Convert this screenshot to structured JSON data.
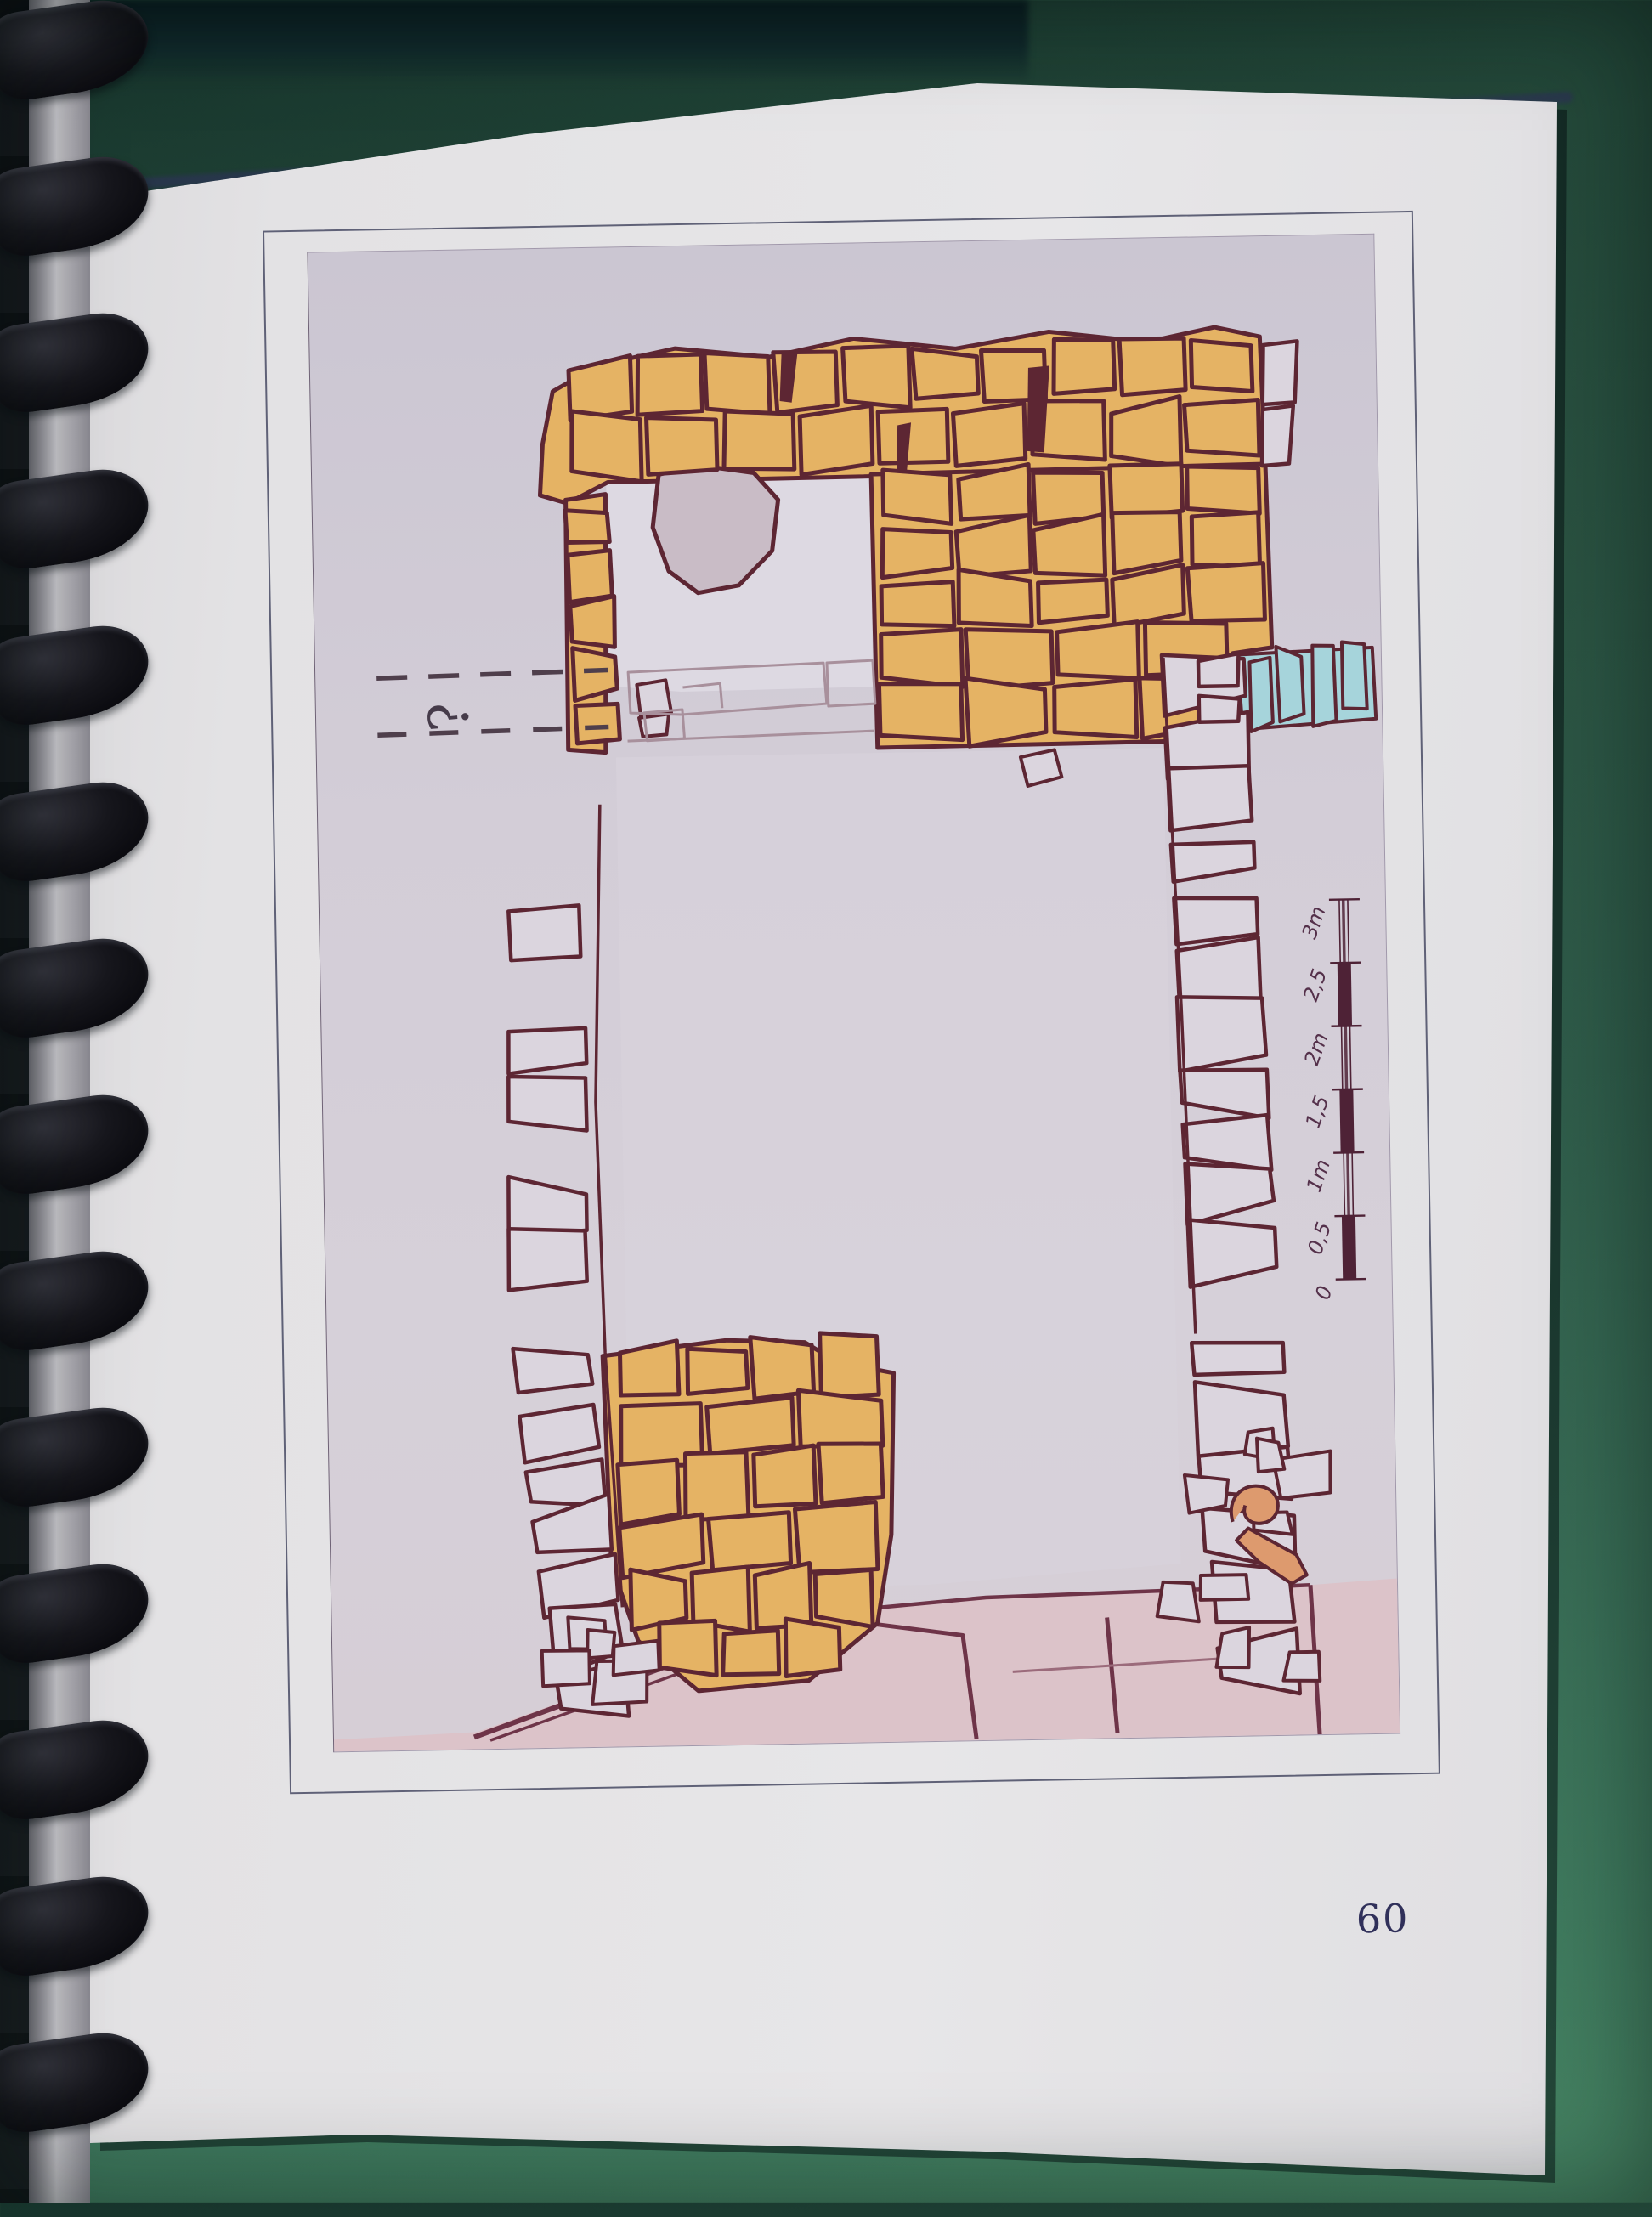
{
  "page": {
    "number": "60"
  },
  "figure": {
    "question_mark": "?",
    "scalebar": {
      "labels": [
        "0",
        "0,5",
        "1m",
        "1,5",
        "2m",
        "2,5",
        "3m"
      ]
    }
  },
  "colors": {
    "desk_green": "#2e5a47",
    "page": "#e4e3e5",
    "plate": "#d3cdd7",
    "ochre": "#e5b364",
    "outline_maroon": "#5d2633",
    "stone_fill": "#dbd5de",
    "blue": "#a6d4db",
    "salmon": "#dd9a6e",
    "bedrock_pink": "#dcc3c9",
    "scalebar_maroon": "#4e2236",
    "binding_black": "#121216"
  }
}
